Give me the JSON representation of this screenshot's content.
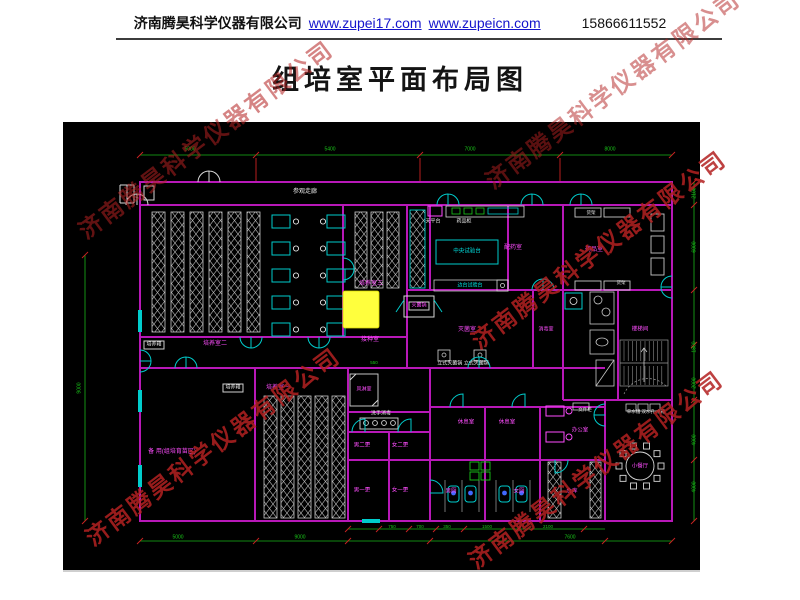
{
  "header": {
    "company": "济南腾昊科学仪器有限公司",
    "link1": "www.zupei17.com",
    "link2": "www.zupeicn.com",
    "phone": "15866611552"
  },
  "title": "组培室平面布局图",
  "watermark": {
    "text": "济南腾昊科学仪器有限公司",
    "color": "#b32121",
    "instances": [
      {
        "x": 205,
        "y": 138,
        "o": 0.55
      },
      {
        "x": 612,
        "y": 88,
        "o": 0.5
      },
      {
        "x": 598,
        "y": 248,
        "o": 0.85
      },
      {
        "x": 212,
        "y": 445,
        "o": 0.85
      },
      {
        "x": 595,
        "y": 468,
        "o": 0.85
      }
    ]
  },
  "floorplan": {
    "labels": [
      {
        "t": "参观走廊",
        "x": 305,
        "y": 192,
        "c": "#e8e8e8",
        "s": 6
      },
      {
        "t": "培养室三",
        "x": 371,
        "y": 284,
        "c": "#ff4dff",
        "s": 6
      },
      {
        "t": "接种室",
        "x": 370,
        "y": 340,
        "c": "#ff4dff",
        "s": 6
      },
      {
        "t": "培养室二",
        "x": 215,
        "y": 344,
        "c": "#ff4dff",
        "s": 6
      },
      {
        "t": "培养箱",
        "x": 154,
        "y": 345,
        "c": "#e8e8e8",
        "s": 5,
        "b": 1
      },
      {
        "t": "培养室一",
        "x": 278,
        "y": 388,
        "c": "#ff4dff",
        "s": 6
      },
      {
        "t": "培养箱",
        "x": 233,
        "y": 388,
        "c": "#e8e8e8",
        "s": 5,
        "b": 1
      },
      {
        "t": "备 用(组培育苗区)",
        "x": 172,
        "y": 452,
        "c": "#ff4dff",
        "s": 6
      },
      {
        "t": "风淋室",
        "x": 364,
        "y": 390,
        "c": "#ff4dff",
        "s": 5
      },
      {
        "t": "洗手消毒",
        "x": 381,
        "y": 414,
        "c": "#e8e8e8",
        "s": 5
      },
      {
        "t": "男二更",
        "x": 362,
        "y": 446,
        "c": "#ff4dff",
        "s": 5.5
      },
      {
        "t": "女二更",
        "x": 400,
        "y": 446,
        "c": "#ff4dff",
        "s": 5.5
      },
      {
        "t": "男一更",
        "x": 362,
        "y": 491,
        "c": "#ff4dff",
        "s": 5.5
      },
      {
        "t": "女一更",
        "x": 400,
        "y": 491,
        "c": "#ff4dff",
        "s": 5.5
      },
      {
        "t": "中央试验台",
        "x": 467,
        "y": 252,
        "c": "#00e5e5",
        "s": 5.5
      },
      {
        "t": "边台试验台",
        "x": 470,
        "y": 286,
        "c": "#00e5e5",
        "s": 5
      },
      {
        "t": "天平台",
        "x": 433,
        "y": 222,
        "c": "#e8e8e8",
        "s": 5
      },
      {
        "t": "药品柜",
        "x": 464,
        "y": 222,
        "c": "#e8e8e8",
        "s": 5
      },
      {
        "t": "配药室",
        "x": 513,
        "y": 248,
        "c": "#ff4dff",
        "s": 6
      },
      {
        "t": "药品室",
        "x": 594,
        "y": 250,
        "c": "#ff4dff",
        "s": 6
      },
      {
        "t": "货架",
        "x": 591,
        "y": 213,
        "c": "#e8e8e8",
        "s": 4.5
      },
      {
        "t": "货架",
        "x": 621,
        "y": 283,
        "c": "#e8e8e8",
        "s": 4.5
      },
      {
        "t": "灭菌锅",
        "x": 419,
        "y": 306,
        "c": "#ff4dff",
        "s": 5,
        "b": 1
      },
      {
        "t": "灭菌室",
        "x": 467,
        "y": 330,
        "c": "#ff4dff",
        "s": 6
      },
      {
        "t": "立式灭菌锅 立式灭菌锅",
        "x": 463,
        "y": 364,
        "c": "#e8e8e8",
        "s": 5
      },
      {
        "t": "消毒室",
        "x": 546,
        "y": 330,
        "c": "#ff4dff",
        "s": 5
      },
      {
        "t": "楼梯间",
        "x": 640,
        "y": 330,
        "c": "#ff4dff",
        "s": 5.5
      },
      {
        "t": "休息室",
        "x": 466,
        "y": 423,
        "c": "#ff4dff",
        "s": 5.5
      },
      {
        "t": "休息室",
        "x": 507,
        "y": 423,
        "c": "#ff4dff",
        "s": 5.5
      },
      {
        "t": "男厕",
        "x": 451,
        "y": 492,
        "c": "#ff4dff",
        "s": 5.5
      },
      {
        "t": "女厕",
        "x": 519,
        "y": 492,
        "c": "#ff4dff",
        "s": 5.5
      },
      {
        "t": "办公室",
        "x": 580,
        "y": 431,
        "c": "#ff4dff",
        "s": 5.5
      },
      {
        "t": "仓库",
        "x": 572,
        "y": 492,
        "c": "#ff4dff",
        "s": 5.5
      },
      {
        "t": "小餐厅",
        "x": 640,
        "y": 467,
        "c": "#ff4dff",
        "s": 5.5
      },
      {
        "t": "单水槽 双水孔 水箱",
        "x": 646,
        "y": 412,
        "c": "#e8e8e8",
        "s": 4.5
      },
      {
        "t": "文件柜",
        "x": 585,
        "y": 410,
        "c": "#e8e8e8",
        "s": 4.5
      },
      {
        "t": "5000",
        "x": 190,
        "y": 150,
        "c": "#19c819",
        "s": 5
      },
      {
        "t": "5400",
        "x": 330,
        "y": 150,
        "c": "#19c819",
        "s": 5
      },
      {
        "t": "7000",
        "x": 470,
        "y": 150,
        "c": "#19c819",
        "s": 5
      },
      {
        "t": "8000",
        "x": 610,
        "y": 150,
        "c": "#19c819",
        "s": 5
      },
      {
        "t": "9000",
        "x": 80,
        "y": 388,
        "c": "#19c819",
        "s": 5,
        "r": -90
      },
      {
        "t": "2100",
        "x": 695,
        "y": 193,
        "c": "#19c819",
        "s": 5,
        "r": -90
      },
      {
        "t": "6000",
        "x": 695,
        "y": 247,
        "c": "#19c819",
        "s": 5,
        "r": -90
      },
      {
        "t": "1800",
        "x": 695,
        "y": 347,
        "c": "#19c819",
        "s": 5,
        "r": -90
      },
      {
        "t": "2000",
        "x": 695,
        "y": 383,
        "c": "#19c819",
        "s": 5,
        "r": -90
      },
      {
        "t": "4000",
        "x": 695,
        "y": 440,
        "c": "#19c819",
        "s": 5,
        "r": -90
      },
      {
        "t": "4000",
        "x": 695,
        "y": 487,
        "c": "#19c819",
        "s": 5,
        "r": -90
      },
      {
        "t": "5000",
        "x": 178,
        "y": 538,
        "c": "#19c819",
        "s": 5
      },
      {
        "t": "9000",
        "x": 300,
        "y": 538,
        "c": "#19c819",
        "s": 5
      },
      {
        "t": "7600",
        "x": 570,
        "y": 538,
        "c": "#19c819",
        "s": 5
      },
      {
        "t": "750",
        "x": 392,
        "y": 527,
        "c": "#19c819",
        "s": 4.5
      },
      {
        "t": "700",
        "x": 420,
        "y": 527,
        "c": "#19c819",
        "s": 4.5
      },
      {
        "t": "350",
        "x": 447,
        "y": 527,
        "c": "#19c819",
        "s": 4.5
      },
      {
        "t": "1500",
        "x": 487,
        "y": 527,
        "c": "#19c819",
        "s": 4.5
      },
      {
        "t": "2100",
        "x": 548,
        "y": 527,
        "c": "#19c819",
        "s": 4.5
      },
      {
        "t": "550",
        "x": 374,
        "y": 363,
        "c": "#19c819",
        "s": 4.5
      }
    ]
  }
}
